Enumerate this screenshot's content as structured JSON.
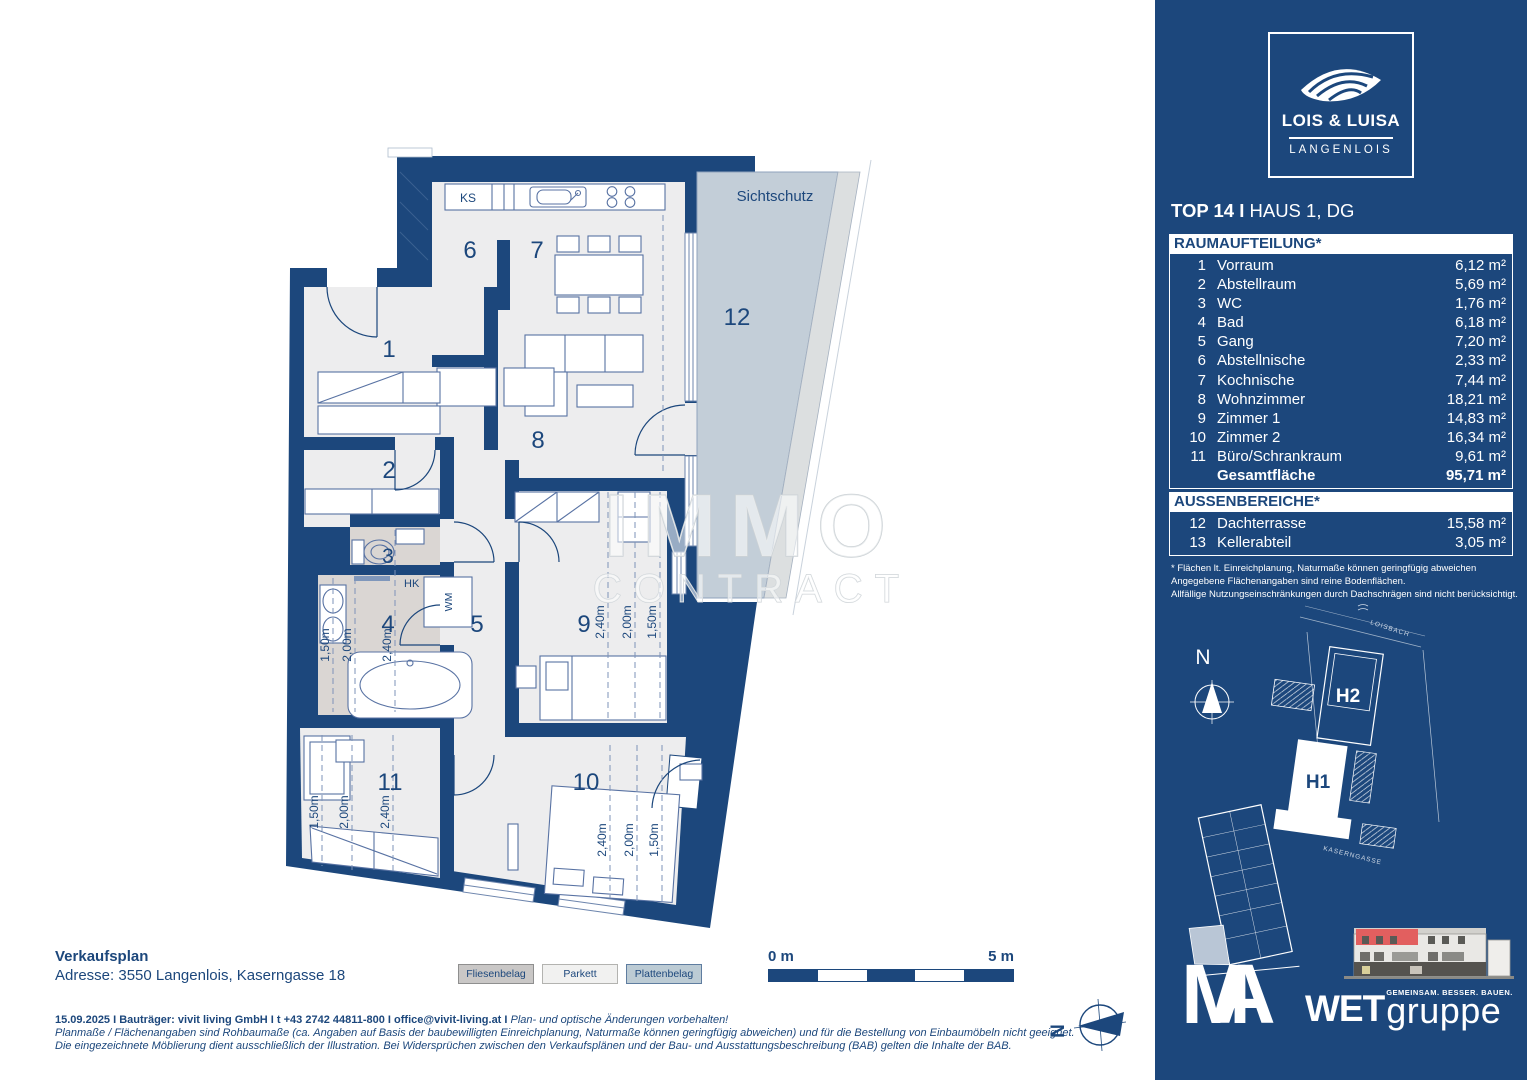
{
  "plan": {
    "rooms": [
      "1",
      "2",
      "3",
      "4",
      "5",
      "6",
      "7",
      "8",
      "9",
      "10",
      "11",
      "12"
    ],
    "labels": {
      "sichtschutz": "Sichtschutz",
      "ks": "KS",
      "wm": "WM",
      "hk": "HK"
    },
    "dims": [
      "1,50m",
      "2,00m",
      "2,40m"
    ],
    "watermark_line1": "IMMO",
    "watermark_line2": "CONTRACT",
    "scale": {
      "start": "0 m",
      "end": "5 m"
    },
    "compass_n": "N"
  },
  "sidebar": {
    "logo": {
      "title": "LOIS & LUISA",
      "subtitle": "LANGENLOIS"
    },
    "unit_title": {
      "bold": "TOP 14 I",
      "rest": " HAUS 1, DG"
    },
    "raum": {
      "header": "RAUMAUFTEILUNG*",
      "rows": [
        {
          "nr": "1",
          "name": "Vorraum",
          "area": "6,12 m²"
        },
        {
          "nr": "2",
          "name": "Abstellraum",
          "area": "5,69 m²"
        },
        {
          "nr": "3",
          "name": "WC",
          "area": "1,76 m²"
        },
        {
          "nr": "4",
          "name": "Bad",
          "area": "6,18 m²"
        },
        {
          "nr": "5",
          "name": "Gang",
          "area": "7,20 m²"
        },
        {
          "nr": "6",
          "name": "Abstellnische",
          "area": "2,33 m²"
        },
        {
          "nr": "7",
          "name": "Kochnische",
          "area": "7,44 m²"
        },
        {
          "nr": "8",
          "name": "Wohnzimmer",
          "area": "18,21 m²"
        },
        {
          "nr": "9",
          "name": "Zimmer 1",
          "area": "14,83 m²"
        },
        {
          "nr": "10",
          "name": "Zimmer 2",
          "area": "16,34 m²"
        },
        {
          "nr": "11",
          "name": "Büro/Schrankraum",
          "area": "9,61 m²"
        }
      ],
      "total": {
        "name": "Gesamtfläche",
        "area": "95,71 m²"
      }
    },
    "aussen": {
      "header": "AUSSENBEREICHE*",
      "rows": [
        {
          "nr": "12",
          "name": "Dachterrasse",
          "area": "15,58 m²"
        },
        {
          "nr": "13",
          "name": "Kellerabteil",
          "area": "3,05 m²"
        }
      ]
    },
    "footnote": [
      "* Flächen lt. Einreichplanung, Naturmaße können geringfügig abweichen",
      "Angegebene Flächenangaben sind reine Bodenflächen.",
      "Allfällige Nutzungseinschränkungen durch Dachschrägen sind nicht berücksichtigt."
    ],
    "siteplan": {
      "north": "N",
      "h1": "H1",
      "h2": "H2",
      "street": "KASERNGASSE",
      "stream": "LOISBACH"
    },
    "ma": {
      "m": "M",
      "a": "A"
    },
    "wet": {
      "bold": "WET",
      "light": "gruppe",
      "tagline": "GEMEINSAM. BESSER. BAUEN."
    }
  },
  "footer": {
    "title": "Verkaufsplan",
    "address": "Adresse: 3550 Langenlois, Kaserngasse 18",
    "legend": [
      {
        "label": "Fliesenbelag",
        "color": "#c9c7c6"
      },
      {
        "label": "Parkett",
        "color": "#f1f1f0"
      },
      {
        "label": "Plattenbelag",
        "color": "#bccbd4"
      }
    ],
    "line1_bold": "15.09.2025 I Bauträger: vivit living GmbH I t +43 2742 44811-800 I office@vivit-living.at I",
    "line1_italic": " Plan- und optische Änderungen vorbehalten!",
    "line2": "Planmaße / Flächenangaben sind Rohbaumaße (ca. Angaben auf Basis der baubewilligten Einreichplanung, Naturmaße können geringfügig abweichen) und für die Bestellung von Einbaumöbeln nicht geeignet.",
    "line3": "Die eingezeichnete Möblierung dient ausschließlich der Illustration. Bei Widersprüchen zwischen den Verkaufsplänen und der Bau- und Ausstattungsbeschreibung (BAB) gelten die Inhalte der BAB."
  },
  "colors": {
    "brand_blue": "#1c477c",
    "floor": "#ededee",
    "bath_floor": "#dad6d3",
    "terrace": "#c3ced8",
    "screen_strip": "#dcdfe0"
  }
}
